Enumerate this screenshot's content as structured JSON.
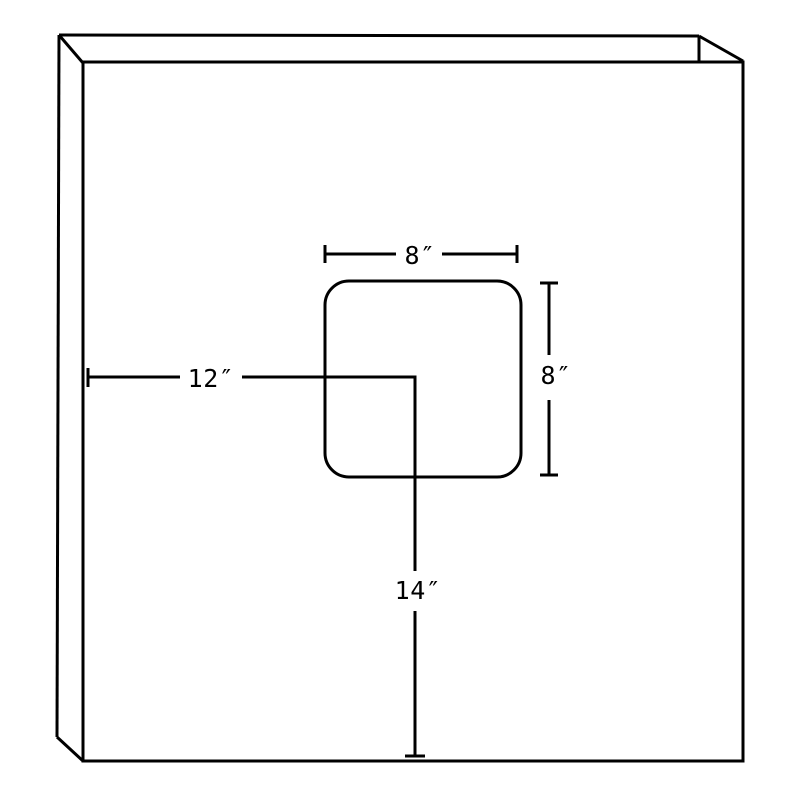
{
  "drawing": {
    "background_color": "#ffffff",
    "line_color": "#000000",
    "subject": "panel-with-square-cutout",
    "dimensions": {
      "cutout_width": "8″",
      "cutout_height": "8″",
      "offset_from_left": "12″",
      "offset_from_bottom": "14″"
    }
  }
}
